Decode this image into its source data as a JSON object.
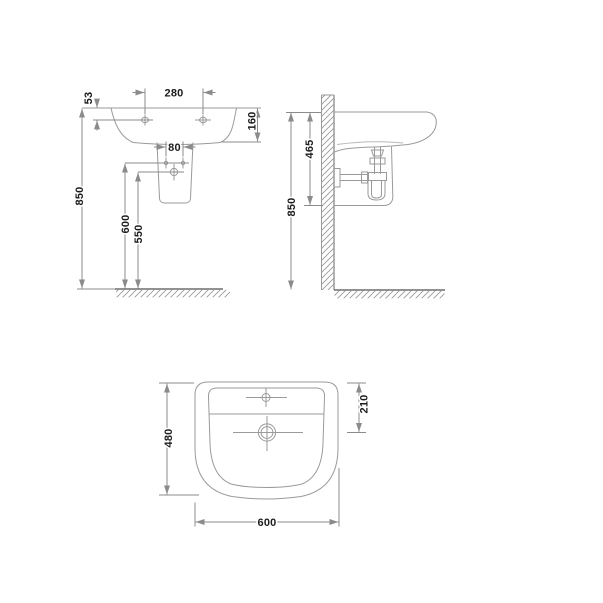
{
  "colors": {
    "background": "#ffffff",
    "outline": "#9a9a9a",
    "outline_light": "#b8b8b8",
    "dimension": "#8b8b8b",
    "ground": "#6f6f6f",
    "text": "#1c1c1c"
  },
  "dimensions": {
    "front": {
      "overall_height": "850",
      "hole_offset": "53",
      "hole_spacing": "280",
      "rim_depth": "160",
      "bolt_spacing": "80",
      "bolt_height": "600",
      "drain_height": "550"
    },
    "side": {
      "overall_height": "850",
      "rim_to_pedestal": "465"
    },
    "plan": {
      "width": "600",
      "depth": "480",
      "drain_offset": "210"
    }
  }
}
